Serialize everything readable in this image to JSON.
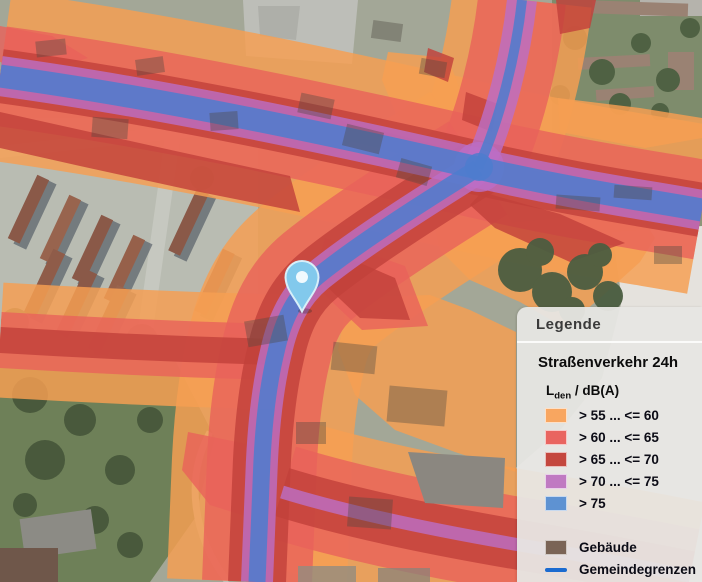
{
  "map": {
    "marker": {
      "type": "location-pin",
      "color": "#7FC6E8"
    }
  },
  "legend": {
    "title": "Legende",
    "section_title": "Straßenverkehr 24h",
    "unit_prefix": "L",
    "unit_sub": "den",
    "unit_suffix": " / dB(A)",
    "classes": [
      {
        "label": "> 55 ... <= 60",
        "color": "#F8A660"
      },
      {
        "label": "> 60 ... <= 65",
        "color": "#E96560"
      },
      {
        "label": "> 65 ... <= 70",
        "color": "#C4473E"
      },
      {
        "label": "> 70 ... <= 75",
        "color": "#C07AC2"
      },
      {
        "label": "> 75",
        "color": "#5E92D2"
      }
    ],
    "buildings": {
      "label": "Gebäude",
      "color": "#7A6456"
    },
    "boundaries": {
      "label": "Gemeindegrenzen",
      "color": "#1B6BD0"
    }
  }
}
